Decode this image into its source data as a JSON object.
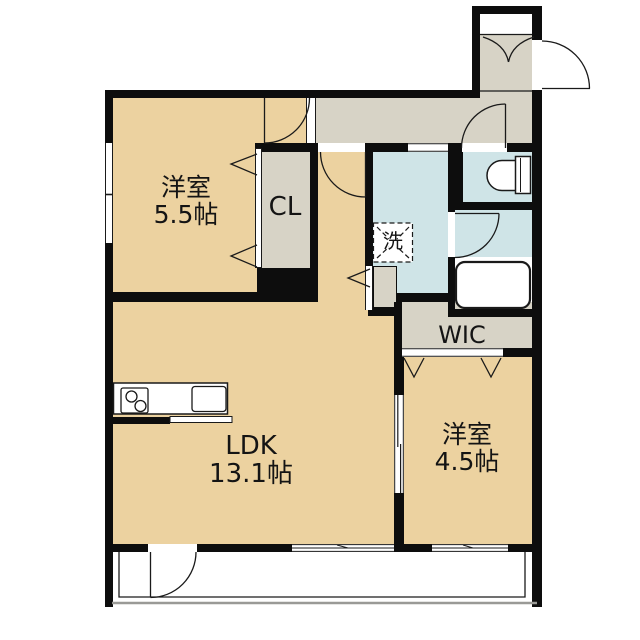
{
  "meta": {
    "drawing_type": "apartment-floor-plan"
  },
  "colors": {
    "wall": "#0d0d0d",
    "room_floor": "#ECD2A0",
    "hall_floor": "#D7D3C6",
    "wet_area_floor": "#CFE4E7",
    "balcony_edge": "#9a9a96"
  },
  "rooms": {
    "bedroom_main": {
      "name": "洋室",
      "size": "5.5帖"
    },
    "bedroom_second": {
      "name": "洋室",
      "size": "4.5帖"
    },
    "ldk": {
      "name": "LDK",
      "size": "13.1帖"
    },
    "closet": {
      "label": "CL"
    },
    "walk_in_closet": {
      "label": "WIC"
    },
    "laundry": {
      "label": "洗"
    }
  },
  "fixtures": {
    "kitchen": [
      "stove-icon",
      "sink-icon",
      "counter"
    ],
    "bathroom": [
      "bathtub-icon",
      "hinged-door"
    ],
    "toilet": [
      "toilet-icon",
      "hinged-door"
    ],
    "laundry": [
      "washing-machine-dashed-box"
    ],
    "entrance": [
      "entry-door-swing",
      "shoe-storage-double-doors",
      "step-line"
    ],
    "windows": [
      "bedroom-left-window",
      "ldk-south-window",
      "bedroom2-south-window"
    ],
    "balcony": [
      "balcony-rail",
      "balcony-door"
    ]
  }
}
